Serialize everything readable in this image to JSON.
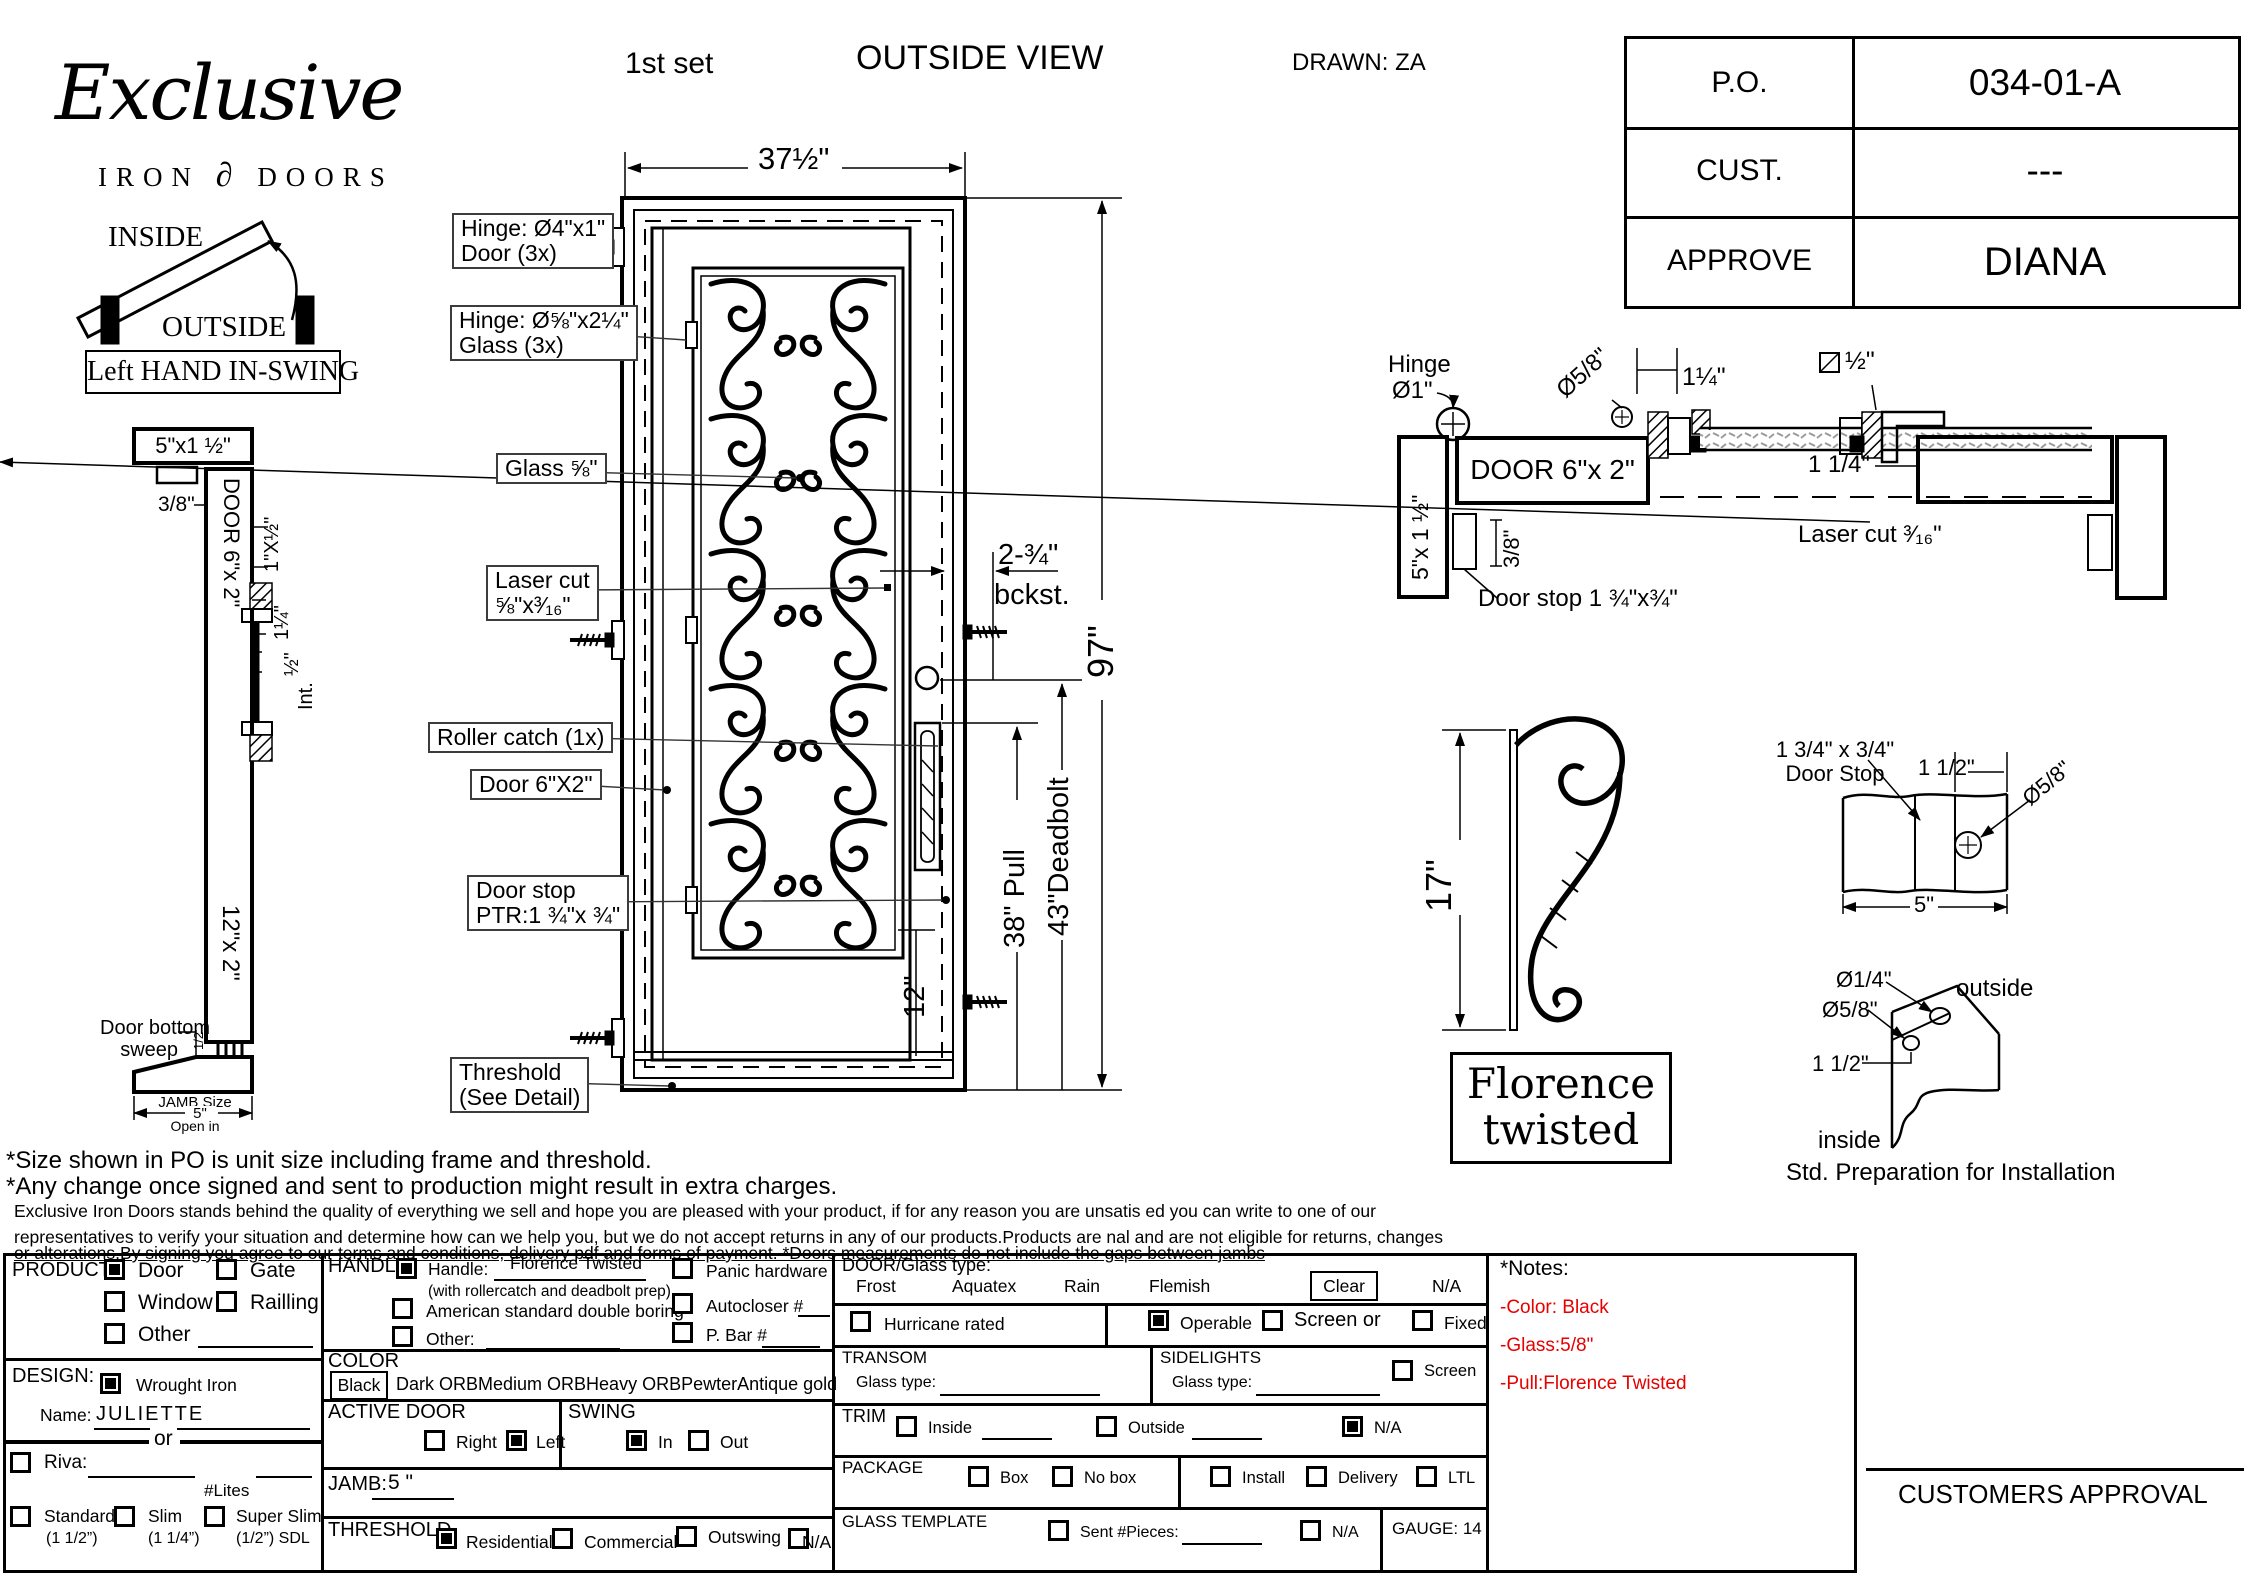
{
  "header": {
    "first_set": "1st set",
    "view_title": "OUTSIDE VIEW",
    "drawn": "DRAWN: ZA"
  },
  "logo": {
    "script": "Exclusive",
    "iron": "IRON",
    "ornament": "∂",
    "doors": "DOORS"
  },
  "approval_table": {
    "rows": [
      {
        "label": "P.O.",
        "value": "034-01-A"
      },
      {
        "label": "CUST.",
        "value": "---"
      },
      {
        "label": "APPROVE",
        "value": "DIANA"
      }
    ]
  },
  "swing": {
    "inside": "INSIDE",
    "outside": "OUTSIDE",
    "caption": "Left HAND IN-SWING"
  },
  "left_section": {
    "top_dim": "5\"x1 ½\"",
    "offset": "3/8\"",
    "door_label": "DOOR 6\"x 2\"",
    "dim_a": "1\"X½\"",
    "dim_b": "1¼\"",
    "dim_c": "½\"",
    "int": "Int.",
    "bottom_label": "12\"x 2\"",
    "sweep_l1": "Door bottom",
    "sweep_l2": "sweep",
    "sweep_half": "1/2",
    "jamb_l1": "JAMB Size",
    "jamb_l2": "5\"",
    "jamb_l3": "Open in"
  },
  "elevation": {
    "width_dim": "37½\"",
    "hinge_door_l1": "Hinge: Ø4\"x1\"",
    "hinge_door_l2": "Door (3x)",
    "hinge_glass_l1": "Hinge: Ø⅝\"x2¼\"",
    "hinge_glass_l2": "Glass (3x)",
    "glass": "Glass ⅝\"",
    "laser_l1": "Laser cut",
    "laser_l2": "⅝\"x³⁄₁₆\"",
    "roller": "Roller catch  (1x)",
    "door": "Door  6\"X2\"",
    "stop_l1": "Door stop",
    "stop_l2": "PTR:1 ¾\"x ¾\"",
    "thresh_l1": "Threshold",
    "thresh_l2": "(See Detail)",
    "backset_l1": "2-¾\"",
    "backset_l2": "bckst.",
    "height": "97\"",
    "pull": "38\" Pull",
    "deadbolt": "43\"Deadbolt",
    "twelve": "12\""
  },
  "plan": {
    "hinge_l1": "Hinge",
    "hinge_l2": "Ø1\"",
    "dia58": "Ø5/8\"",
    "dim125": "1¼\"",
    "sq_half": "½\"",
    "door": "DOOR 6\"x 2\"",
    "jamb": "5\"x 1 ½\"",
    "offset": "3/8\"",
    "doorstop": "Door stop 1 ¾\"x¾\"",
    "dim114": "1 1/4\"",
    "laser": "Laser cut ³⁄₁₆\""
  },
  "pull_detail": {
    "height": "17\"",
    "name_l1": "Florence",
    "name_l2": "twisted"
  },
  "stop_detail": {
    "size_l1": "1 3/4\" x 3/4\"",
    "size_l2": "Door Stop",
    "w112": "1 1/2\"",
    "dia": "Ø5/8\"",
    "w5": "5\""
  },
  "prep_detail": {
    "dia14": "Ø1/4\"",
    "outside": "outside",
    "dia58": "Ø5/8\"",
    "d112": "1 1/2\"",
    "inside": "inside",
    "caption": "Std. Preparation for Installation"
  },
  "notes": {
    "line1": "*Size shown in PO is unit size including frame and threshold.",
    "line2": "*Any change once signed and sent to production might result in extra charges.",
    "para1": "Exclusive Iron Doors stands behind the quality of everything we sell and hope you are pleased with your product, if for any reason you are unsatis   ed you can write to one of our",
    "para2": "representatives to verify your situation and determine how can we help you, but we do not accept returns in any of our products.Products are    nal and are not eligible for returns, changes",
    "para3": "or alterations.By signing you agree to our terms and conditions, delivery pdf and forms of payment. *Doors measurements do not include the gaps between jambs"
  },
  "form": {
    "product": {
      "label": "PRODUCT: ",
      "door": "Door",
      "gate": "Gate",
      "window": "Window",
      "railing": "Railling",
      "other": "Other"
    },
    "design": {
      "label": "DESIGN:",
      "wrought": "Wrought Iron",
      "name_label": "Name:",
      "name_value": "JULIETTE",
      "or": "or",
      "riva": "Riva:",
      "lites": "#Lites",
      "standard": "Standard",
      "standard_sub": "(1 1/2”)",
      "slim": "Slim",
      "slim_sub": "(1 1/4”)",
      "superslim": "Super Slim",
      "superslim_sub": "(1/2”) SDL"
    },
    "handle": {
      "label": "HANDLE",
      "handle": "Handle:",
      "value": "Florence Twisted",
      "sub": "(with rollercatch and deadbolt prep)",
      "american": "American standard double boring",
      "other": "Other:",
      "panic": "Panic hardware",
      "autocloser": "Autocloser #",
      "pbar": "P. Bar #"
    },
    "color": {
      "label": "COLOR",
      "selected": "Black",
      "options": [
        "Dark ORB",
        "Medium ORB",
        "Heavy ORB",
        "Pewter",
        "Antique gold"
      ]
    },
    "active": {
      "label": "ACTIVE DOOR",
      "right": "Right",
      "left": "Left"
    },
    "swing": {
      "label": "SWING",
      "in": "In",
      "out": "Out"
    },
    "jamb": {
      "label": "JAMB:",
      "value": "5 \""
    },
    "threshold": {
      "label": "THRESHOLD",
      "residential": "Residential",
      "commercial": "Commercial",
      "outswing": "Outswing",
      "na": "N/A"
    },
    "glass": {
      "label": "DOOR/Glass type:",
      "frost": "Frost",
      "aquatex": "Aquatex",
      "rain": "Rain",
      "flemish": "Flemish",
      "clear": "Clear",
      "na": "N/A",
      "hurricane": "Hurricane rated",
      "operable": "Operable",
      "screen_or": "Screen or",
      "fixed": "Fixed"
    },
    "transom": {
      "label": "TRANSOM",
      "glass_type": "Glass type:"
    },
    "sidelights": {
      "label": "SIDELIGHTS",
      "glass_type": "Glass type:",
      "screen": "Screen"
    },
    "trim": {
      "label": "TRIM",
      "inside": "Inside",
      "outside": "Outside",
      "na": "N/A"
    },
    "package": {
      "label": "PACKAGE",
      "box": "Box",
      "nobox": "No box",
      "install": "Install",
      "delivery": "Delivery",
      "ltl": "LTL"
    },
    "glass_template": {
      "label": "GLASS TEMPLATE",
      "sent": "Sent #Pieces:",
      "na": "N/A",
      "gauge": "GAUGE: 14"
    },
    "notes": {
      "title": "*Notes:",
      "color": "-Color: Black",
      "glass": "-Glass:5/8\"",
      "pull": "-Pull:Florence Twisted"
    },
    "approval": "CUSTOMERS APPROVAL"
  },
  "colors": {
    "ink": "#000000",
    "paper": "#ffffff",
    "note_red": "#e60000"
  }
}
